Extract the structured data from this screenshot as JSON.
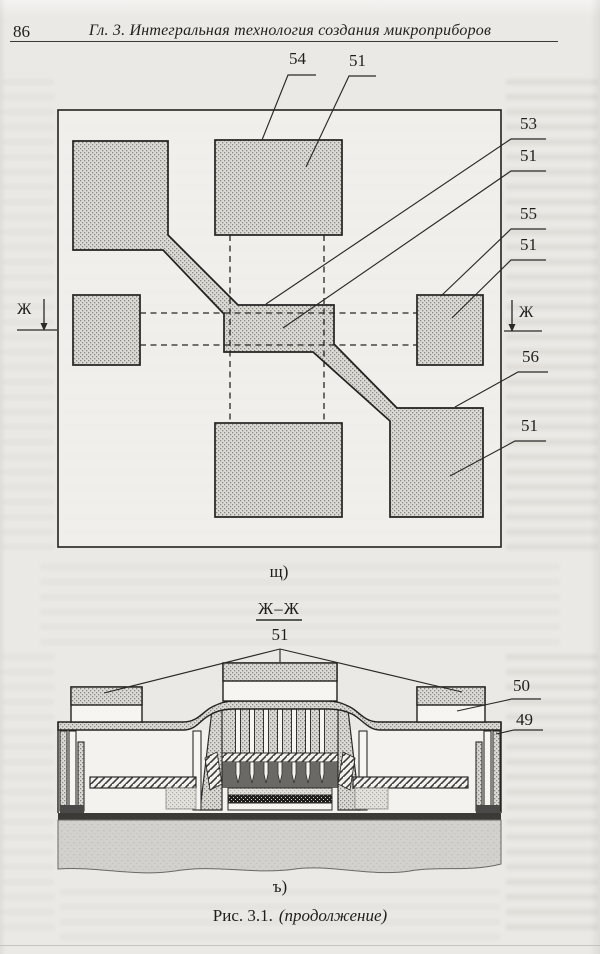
{
  "page": {
    "number": "86",
    "header_title": "Гл. 3. Интегральная технология создания микроприборов"
  },
  "figure_plan": {
    "callouts": {
      "c54": "54",
      "c51_top": "51",
      "c53": "53",
      "c51_mid": "51",
      "c55": "55",
      "c51_right": "51",
      "c56": "56",
      "c51_bottom": "51"
    },
    "section_marker_left": "Ж",
    "section_marker_right": "Ж",
    "panel_label": "щ)"
  },
  "figure_section": {
    "title": "Ж–Ж",
    "callouts": {
      "c51": "51",
      "c50": "50",
      "c49": "49"
    },
    "panel_label": "ъ)"
  },
  "caption": {
    "figure": "Рис. 3.1.",
    "continuation": "(продолжение)"
  },
  "colors": {
    "ink": "#222220",
    "page_bg": "#ebe9e5",
    "stipple_fill": "#dcdad5",
    "substrate_fill": "#d3d1cd"
  }
}
